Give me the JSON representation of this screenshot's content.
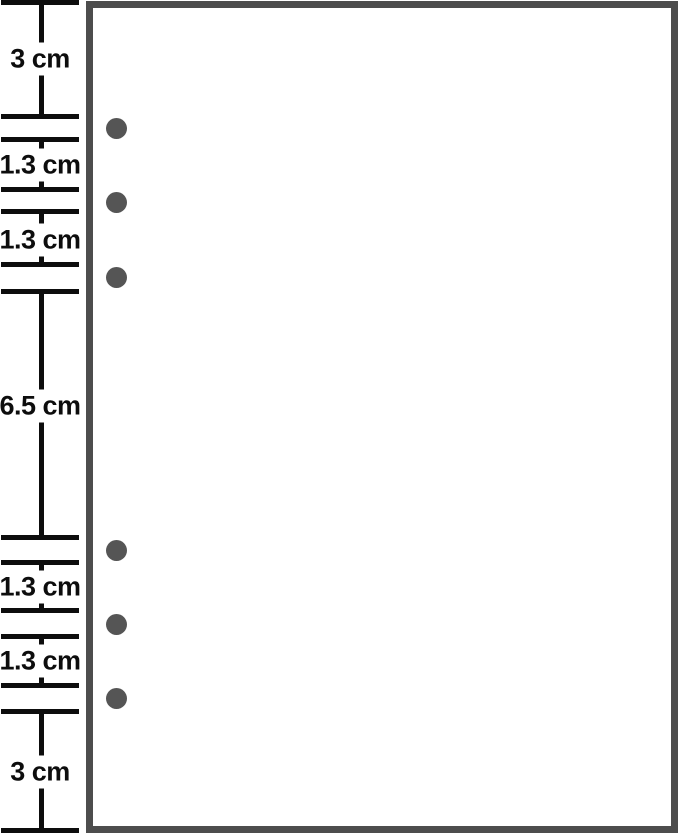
{
  "canvas": {
    "width": 679,
    "height": 835
  },
  "colors": {
    "background": "#ffffff",
    "ruler": "#0d0d0d",
    "label_text": "#0d0d0d",
    "page_border": "#4d4d4d",
    "page_background": "#ffffff",
    "hole": "#555555"
  },
  "ruler": {
    "tick_x": 1,
    "tick_width": 78,
    "tick_thickness": 5,
    "line_x_center": 41,
    "line_thickness": 5,
    "label_x_center": 40,
    "ticks_y": [
      2,
      116,
      139,
      189,
      211,
      264,
      291,
      537,
      562,
      610,
      636,
      685,
      711,
      830
    ],
    "segments": [
      {
        "label": "3 cm",
        "value_cm": 3,
        "top": 2,
        "bottom": 116,
        "label_y": 59
      },
      {
        "label": "1.3 cm",
        "value_cm": 1.3,
        "top": 139,
        "bottom": 189,
        "label_y": 165
      },
      {
        "label": "1.3 cm",
        "value_cm": 1.3,
        "top": 211,
        "bottom": 264,
        "label_y": 240
      },
      {
        "label": "6.5 cm",
        "value_cm": 6.5,
        "top": 291,
        "bottom": 537,
        "label_y": 406
      },
      {
        "label": "1.3 cm",
        "value_cm": 1.3,
        "top": 562,
        "bottom": 610,
        "label_y": 587
      },
      {
        "label": "1.3 cm",
        "value_cm": 1.3,
        "top": 636,
        "bottom": 685,
        "label_y": 661
      },
      {
        "label": "3 cm",
        "value_cm": 3,
        "top": 711,
        "bottom": 830,
        "label_y": 772
      }
    ]
  },
  "page": {
    "x": 86,
    "y": 1,
    "width": 592,
    "height": 832,
    "border_thickness": 7,
    "holes": {
      "cx": 116.5,
      "radius": 10.5,
      "cy": [
        128,
        202,
        277,
        550,
        624,
        698
      ]
    }
  }
}
